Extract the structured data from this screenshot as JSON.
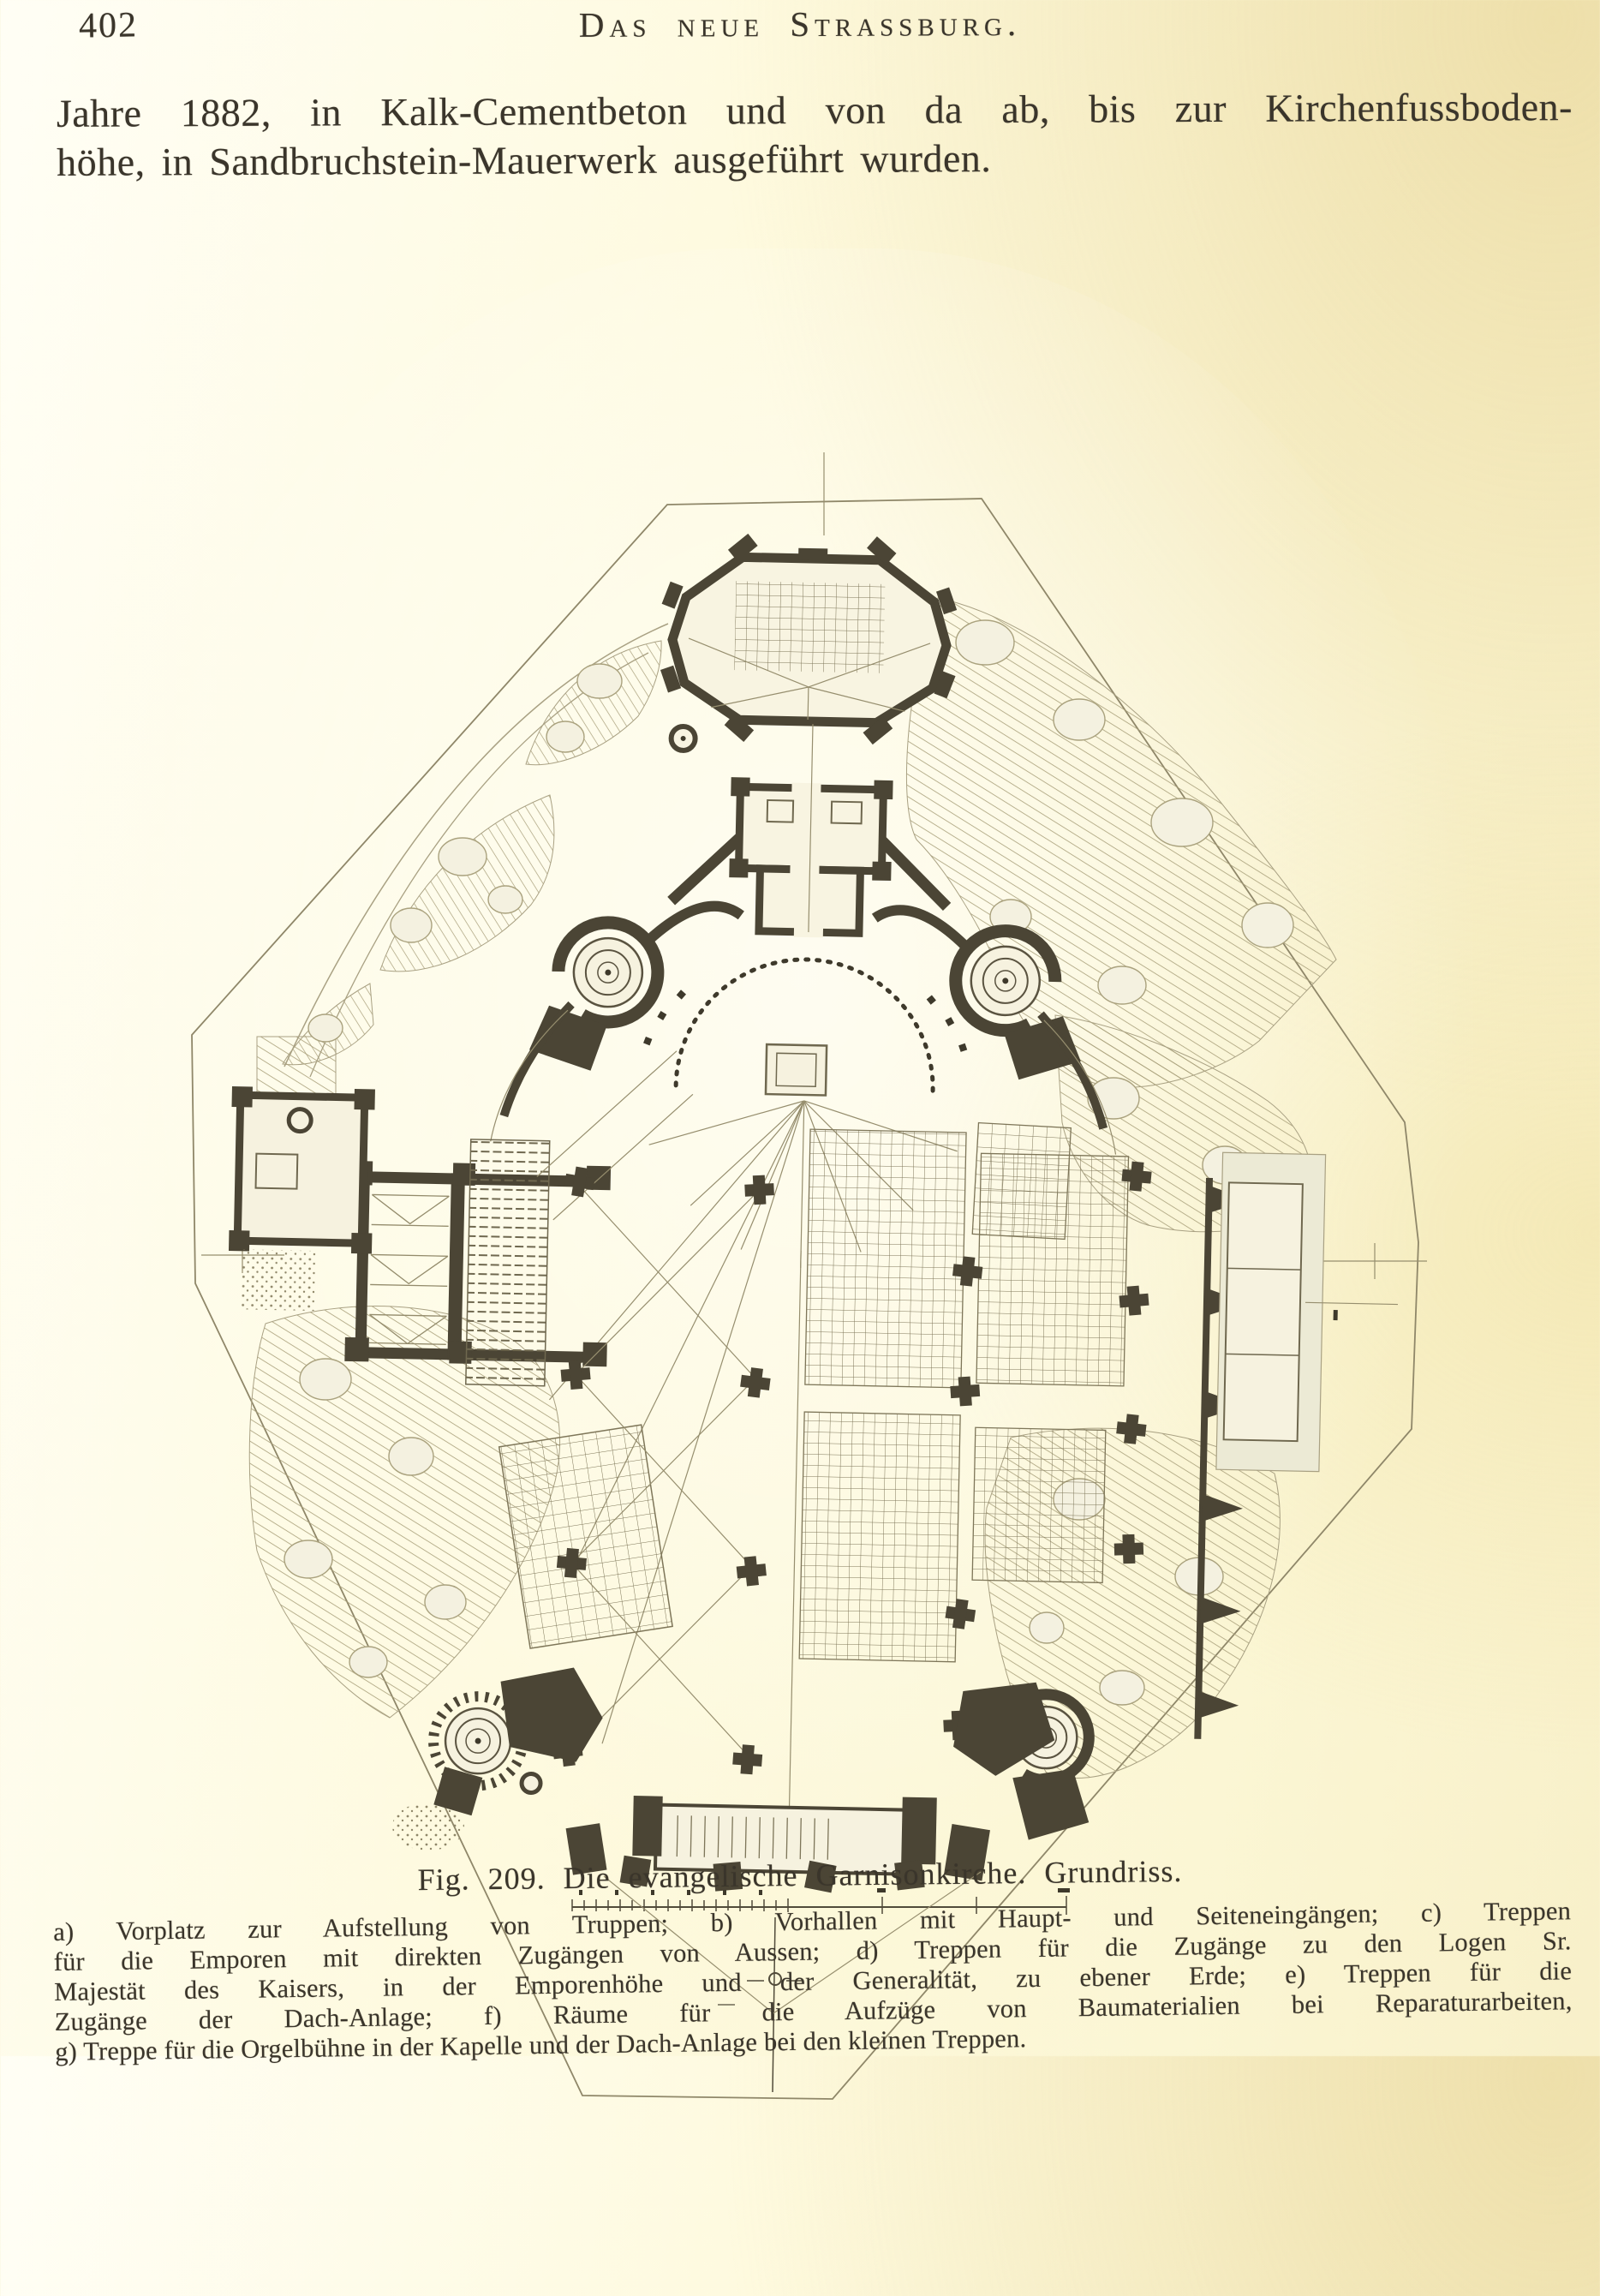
{
  "page_number": "402",
  "running_header": "Das neue Strassburg.",
  "paragraph": {
    "line1": "Jahre 1882, in Kalk-Cementbeton und von da ab, bis zur Kirchenfussboden-",
    "line2": "höhe, in Sandbruchstein-Mauerwerk ausgeführt wurden."
  },
  "figure": {
    "caption": "Fig. 209.  Die evangelische Garnisonkirche.  Grundriss."
  },
  "legend_lines": [
    "a) Vorplatz zur Aufstellung von Truppen; b) Vorhallen mit Haupt- und Seiteneingängen; c) Treppen",
    "für die Emporen mit direkten Zugängen von Aussen; d) Treppen für die Zugänge zu den Logen Sr.",
    "Majestät des Kaisers, in der Emporenhöhe und der Generalität, zu ebener Erde; e) Treppen für die",
    "Zugänge der Dach-Anlage; f) Räume für die Aufzüge von Baumaterialien bei Reparaturarbeiten,",
    "g) Treppe für die Orgelbühne in der Kapelle und der Dach-Anlage bei den kleinen Treppen."
  ],
  "colors": {
    "paper": "#fdf9dc",
    "ink": "#35302a",
    "plan_wall": "#4b4535",
    "plan_hatch": "#a89f7a"
  }
}
